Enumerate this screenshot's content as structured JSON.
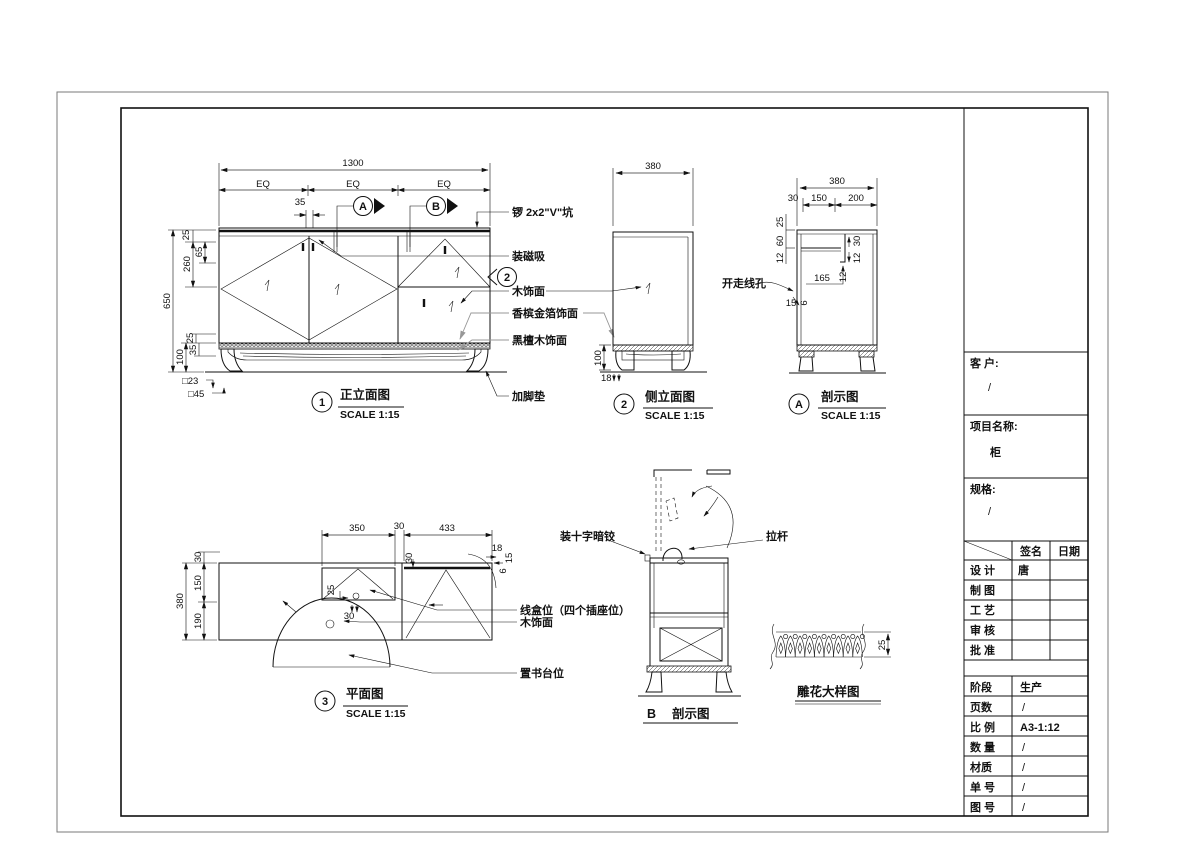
{
  "front": {
    "no": "1",
    "title": "正立面图",
    "scale": "SCALE 1:15",
    "d1300": "1300",
    "eq1": "EQ",
    "eq2": "EQ",
    "eq3": "EQ",
    "d35": "35",
    "d25_top": "25",
    "d65": "65",
    "d260": "260",
    "d650": "650",
    "d25_base": "25",
    "d100": "100",
    "d35_base": "35",
    "sq23": "□23",
    "sq45": "□45",
    "ma": "A",
    "mb": "B",
    "m2": "2",
    "co_v": "锣 2x2\"V\"坑",
    "co_mag": "装磁吸",
    "co_wood": "木饰面",
    "co_gold": "香槟金箔饰面",
    "co_ebony": "黑檀木饰面",
    "co_foot": "加脚垫"
  },
  "side": {
    "no": "2",
    "title": "侧立面图",
    "scale": "SCALE 1:15",
    "d380": "380",
    "d100": "100",
    "d18": "18"
  },
  "secA": {
    "no": "A",
    "title": "剖示图",
    "scale": "SCALE 1:15",
    "d380": "380",
    "d30": "30",
    "d150": "150",
    "d200": "200",
    "d25": "25",
    "d60": "60",
    "d12_left": "12",
    "d30_right": "30",
    "d12_right": "12",
    "d165": "165",
    "d12_mid": "12",
    "d15": "15",
    "d6": "6",
    "co_hole": "开走线孔"
  },
  "plan": {
    "no": "3",
    "title": "平面图",
    "scale": "SCALE 1:15",
    "d350": "350",
    "d30_top": "30",
    "d433": "433",
    "d18": "18",
    "d15": "15",
    "d6": "6",
    "d30_mid": "30",
    "d30_left": "30",
    "d150": "150",
    "d190": "190",
    "d380": "380",
    "d25": "25",
    "d30_box": "30",
    "co_socket": "线盒位（四个插座位）",
    "co_wood": "木饰面",
    "co_book": "置书台位"
  },
  "secB": {
    "no": "B",
    "title": "剖示图",
    "co_hinge": "装十字暗铰",
    "co_rod": "拉杆"
  },
  "carve": {
    "title": "雕花大样图",
    "d25": "25"
  },
  "tb": {
    "client_label": "客 户:",
    "client": "/",
    "project_label": "项目名称:",
    "project": "柜",
    "spec_label": "规格:",
    "spec": "/",
    "sign": "签名",
    "date": "日期",
    "rows": [
      {
        "label": "设 计",
        "sign": "唐"
      },
      {
        "label": "制 图",
        "sign": ""
      },
      {
        "label": "工 艺",
        "sign": ""
      },
      {
        "label": "审 核",
        "sign": ""
      },
      {
        "label": "批 准",
        "sign": ""
      }
    ],
    "stage_label": "阶段",
    "stage": "生产",
    "pages_label": "页数",
    "pages": "/",
    "ratio_label": "比 例",
    "ratio": "A3-1:12",
    "qty_label": "数 量",
    "qty": "/",
    "material_label": "材质",
    "material": "/",
    "order_label": "单 号",
    "order": "/",
    "drawing_label": "图 号",
    "drawing": "/"
  }
}
